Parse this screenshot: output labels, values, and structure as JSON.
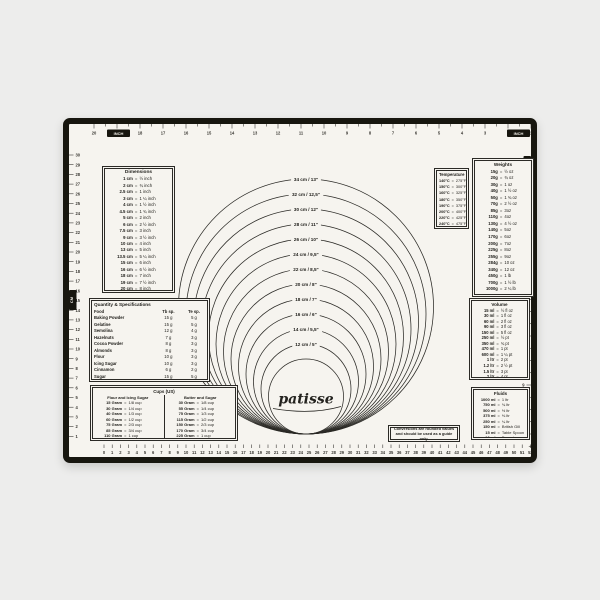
{
  "brand": "patisse",
  "colors": {
    "background": "#ededec",
    "mat": "#f6f4ef",
    "line": "#2b2a26",
    "frame": "#17160f"
  },
  "logo": {
    "text": "patisse"
  },
  "note": {
    "line1": "Conversions are rounded values",
    "line2": "and should be used as a guide only."
  },
  "rulers": {
    "top": {
      "unit_label": "INCH",
      "numbers": [
        20,
        19,
        18,
        17,
        16,
        15,
        14,
        13,
        12,
        11,
        10,
        9,
        8,
        7,
        6,
        5,
        4,
        3,
        2,
        1
      ]
    },
    "left": {
      "unit_label": "CM",
      "numbers": [
        30,
        29,
        28,
        27,
        26,
        25,
        24,
        23,
        22,
        21,
        20,
        19,
        18,
        17,
        16,
        15,
        14,
        13,
        12,
        11,
        10,
        9,
        8,
        7,
        6,
        5,
        4,
        3,
        2,
        1
      ]
    },
    "right": {
      "unit_label": "INCH",
      "numbers": [
        1,
        2,
        3,
        4,
        5,
        6,
        7,
        8,
        9,
        10,
        11,
        12
      ]
    },
    "bottom": {
      "unit_label": "CM",
      "numbers": [
        0,
        1,
        2,
        3,
        4,
        5,
        6,
        7,
        8,
        9,
        10,
        11,
        12,
        13,
        14,
        15,
        16,
        17,
        18,
        19,
        20,
        21,
        22,
        23,
        24,
        25,
        26,
        27,
        28,
        29,
        30,
        31,
        32,
        33,
        34,
        35,
        36,
        37,
        38,
        39,
        40,
        41,
        42,
        43,
        44,
        45,
        46,
        47,
        48,
        49,
        50,
        51,
        52
      ]
    }
  },
  "circles": {
    "diameters_cm": [
      34,
      32,
      30,
      28,
      26,
      24,
      22,
      20,
      18,
      16,
      14,
      12
    ],
    "labels": [
      "34 cm / 13\"",
      "32 cm / 12,5\"",
      "30 cm / 12\"",
      "28 cm / 11\"",
      "26 cm / 10\"",
      "24 cm / 9,5\"",
      "22 cm / 8,5\"",
      "20 cm / 8\"",
      "18 cm / 7\"",
      "16 cm / 6\"",
      "14 cm / 5,5\"",
      "12 cm / 5\""
    ],
    "logo_circle_cm": 10
  },
  "tables": {
    "dimensions": {
      "title": "Dimensions",
      "rows": [
        [
          "1 cm",
          "=",
          "½ inch"
        ],
        [
          "2 cm",
          "=",
          "¾ inch"
        ],
        [
          "2.5 cm",
          "=",
          "1 inch"
        ],
        [
          "3 cm",
          "=",
          "1 ¼ inch"
        ],
        [
          "4 cm",
          "=",
          "1 ½ inch"
        ],
        [
          "4.5 cm",
          "=",
          "1 ¾ inch"
        ],
        [
          "5 cm",
          "=",
          "2 inch"
        ],
        [
          "6 cm",
          "=",
          "2 ½ inch"
        ],
        [
          "7.5 cm",
          "=",
          "3 inch"
        ],
        [
          "9 cm",
          "=",
          "3 ½ inch"
        ],
        [
          "10 cm",
          "=",
          "4 inch"
        ],
        [
          "13 cm",
          "=",
          "5 inch"
        ],
        [
          "13.5 cm",
          "=",
          "5 ¼ inch"
        ],
        [
          "15 cm",
          "=",
          "6 inch"
        ],
        [
          "16 cm",
          "=",
          "6 ½ inch"
        ],
        [
          "18 cm",
          "=",
          "7 inch"
        ],
        [
          "19 cm",
          "=",
          "7 ½ inch"
        ],
        [
          "20 cm",
          "=",
          "8 inch"
        ]
      ]
    },
    "quantity": {
      "title": "Quantity & Specifications",
      "headers": [
        "Food",
        "Tb sp.",
        "Te sp."
      ],
      "rows": [
        [
          "Baking Powder",
          "15 g",
          "5 g"
        ],
        [
          "Gelatine",
          "15 g",
          "5 g"
        ],
        [
          "Semolina",
          "12 g",
          "4 g"
        ],
        [
          "Hazelnuts",
          "7 g",
          "3 g"
        ],
        [
          "Cocoa Powder",
          "8 g",
          "3 g"
        ],
        [
          "Almonds",
          "8 g",
          "3 g"
        ],
        [
          "Flour",
          "10 g",
          "3 g"
        ],
        [
          "Icing Sugar",
          "10 g",
          "3 g"
        ],
        [
          "Cinnamon",
          "6 g",
          "2 g"
        ],
        [
          "Sugar",
          "15 g",
          "5 g"
        ]
      ]
    },
    "cups": {
      "title": "Cups (US)",
      "groups": [
        {
          "name": "Flour and Icing Sugar",
          "rows": [
            [
              "15 Gram",
              "=",
              "1/8 cup"
            ],
            [
              "30 Gram",
              "=",
              "1/4 cup"
            ],
            [
              "40 Gram",
              "=",
              "1/3 cup"
            ],
            [
              "60 Gram",
              "=",
              "1/2 cup"
            ],
            [
              "75 Gram",
              "=",
              "2/3 cup"
            ],
            [
              "85 Gram",
              "=",
              "3/4 cup"
            ],
            [
              "110 Gram",
              "=",
              "1 cup"
            ]
          ]
        },
        {
          "name": "Butter and Sugar",
          "rows": [
            [
              "30 Gram",
              "=",
              "1/8 cup"
            ],
            [
              "55 Gram",
              "=",
              "1/4 cup"
            ],
            [
              "75 Gram",
              "=",
              "1/3 cup"
            ],
            [
              "115 Gram",
              "=",
              "1/2 cup"
            ],
            [
              "150 Gram",
              "=",
              "2/3 cup"
            ],
            [
              "170 Gram",
              "=",
              "3/4 cup"
            ],
            [
              "225 Gram",
              "=",
              "1 cup"
            ]
          ]
        }
      ]
    },
    "temperature": {
      "title": "Temperature",
      "rows": [
        [
          "140°C",
          "=",
          "275°F"
        ],
        [
          "150°C",
          "=",
          "300°F"
        ],
        [
          "160°C",
          "=",
          "325°F"
        ],
        [
          "180°C",
          "=",
          "350°F"
        ],
        [
          "190°C",
          "=",
          "375°F"
        ],
        [
          "200°C",
          "=",
          "400°F"
        ],
        [
          "220°C",
          "=",
          "425°F"
        ],
        [
          "240°C",
          "=",
          "475°F"
        ]
      ]
    },
    "weights": {
      "title": "Weights",
      "rows": [
        [
          "15g",
          "=",
          "½ oz"
        ],
        [
          "20g",
          "=",
          "¾ oz"
        ],
        [
          "30g",
          "=",
          "1 oz"
        ],
        [
          "40g",
          "=",
          "1 ½ oz"
        ],
        [
          "50g",
          "=",
          "1 ¾ oz"
        ],
        [
          "70g",
          "=",
          "2 ½ oz"
        ],
        [
          "85g",
          "=",
          "3oz"
        ],
        [
          "110g",
          "=",
          "4oz"
        ],
        [
          "130g",
          "=",
          "4 ½ oz"
        ],
        [
          "140g",
          "=",
          "5oz"
        ],
        [
          "170g",
          "=",
          "6oz"
        ],
        [
          "200g",
          "=",
          "7oz"
        ],
        [
          "225g",
          "=",
          "8oz"
        ],
        [
          "255g",
          "=",
          "9oz"
        ],
        [
          "284g",
          "=",
          "10 oz"
        ],
        [
          "340g",
          "=",
          "12 oz"
        ],
        [
          "450g",
          "=",
          "1 lb"
        ],
        [
          "700g",
          "=",
          "1 ½ lb"
        ],
        [
          "1000g",
          "=",
          "2 ¼ lb"
        ]
      ]
    },
    "volume": {
      "title": "Volume",
      "rows": [
        [
          "15 ml",
          "=",
          "½ fl oz"
        ],
        [
          "30 ml",
          "=",
          "1 fl oz"
        ],
        [
          "60 ml",
          "=",
          "2 fl oz"
        ],
        [
          "90 ml",
          "=",
          "3 fl oz"
        ],
        [
          "150 ml",
          "=",
          "5 fl oz"
        ],
        [
          "250 ml",
          "=",
          "½ pt"
        ],
        [
          "350 ml",
          "=",
          "¾ pt"
        ],
        [
          "470 ml",
          "=",
          "1 pt"
        ],
        [
          "600 ml",
          "=",
          "1 ¼ pt"
        ],
        [
          "1 ltr",
          "=",
          "2 pt"
        ],
        [
          "1.2 ltr",
          "=",
          "2 ½ pt"
        ],
        [
          "1.5 ltr",
          "=",
          "3 pt"
        ],
        [
          "2 ltr",
          "=",
          "4 pt"
        ]
      ]
    },
    "fluids": {
      "title": "Fluids",
      "rows": [
        [
          "1000 ml",
          "=",
          "1 ltr"
        ],
        [
          "750 ml",
          "=",
          "¾ ltr"
        ],
        [
          "500 ml",
          "=",
          "½ ltr"
        ],
        [
          "375 ml",
          "=",
          "⅜ ltr"
        ],
        [
          "250 ml",
          "=",
          "¼ ltr"
        ],
        [
          "150 ml",
          "=",
          "British Gill"
        ],
        [
          "15 ml",
          "=",
          "Table Spoon"
        ],
        [
          "10 ml",
          "=",
          "Desert Spoon"
        ]
      ]
    }
  }
}
